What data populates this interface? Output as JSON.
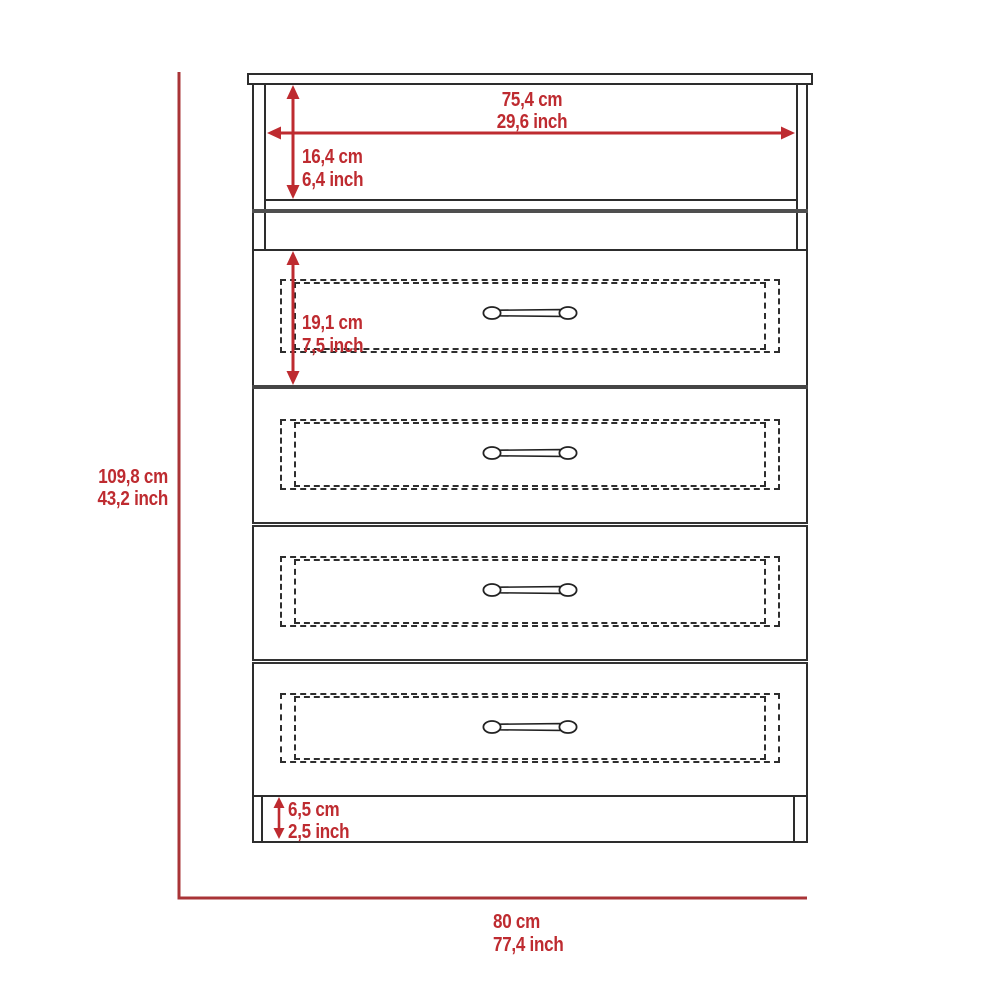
{
  "diagram": {
    "title": "four-drawer-dresser-dimension-diagram",
    "subject": "Front view of a 4-drawer dresser with one open top shelf",
    "drawer_count": 4,
    "colors": {
      "dimension_red": "#be2b30",
      "outline_red": "#a93437",
      "line_dark": "#2d2d2d",
      "divider_gray": "#454545",
      "background": "#ffffff"
    },
    "dimensions": {
      "interior_width": {
        "cm": "75,4 cm",
        "inch": "29,6 inch"
      },
      "top_compartment_height": {
        "cm": "16,4 cm",
        "inch": "6,4 inch"
      },
      "drawer_height": {
        "cm": "19,1 cm",
        "inch": "7,5 inch"
      },
      "overall_height": {
        "cm": "109,8 cm",
        "inch": "43,2 inch"
      },
      "base_height": {
        "cm": "6,5 cm",
        "inch": "2,5 inch"
      },
      "overall_width": {
        "cm": "80 cm",
        "inch": "77,4 inch"
      }
    }
  }
}
